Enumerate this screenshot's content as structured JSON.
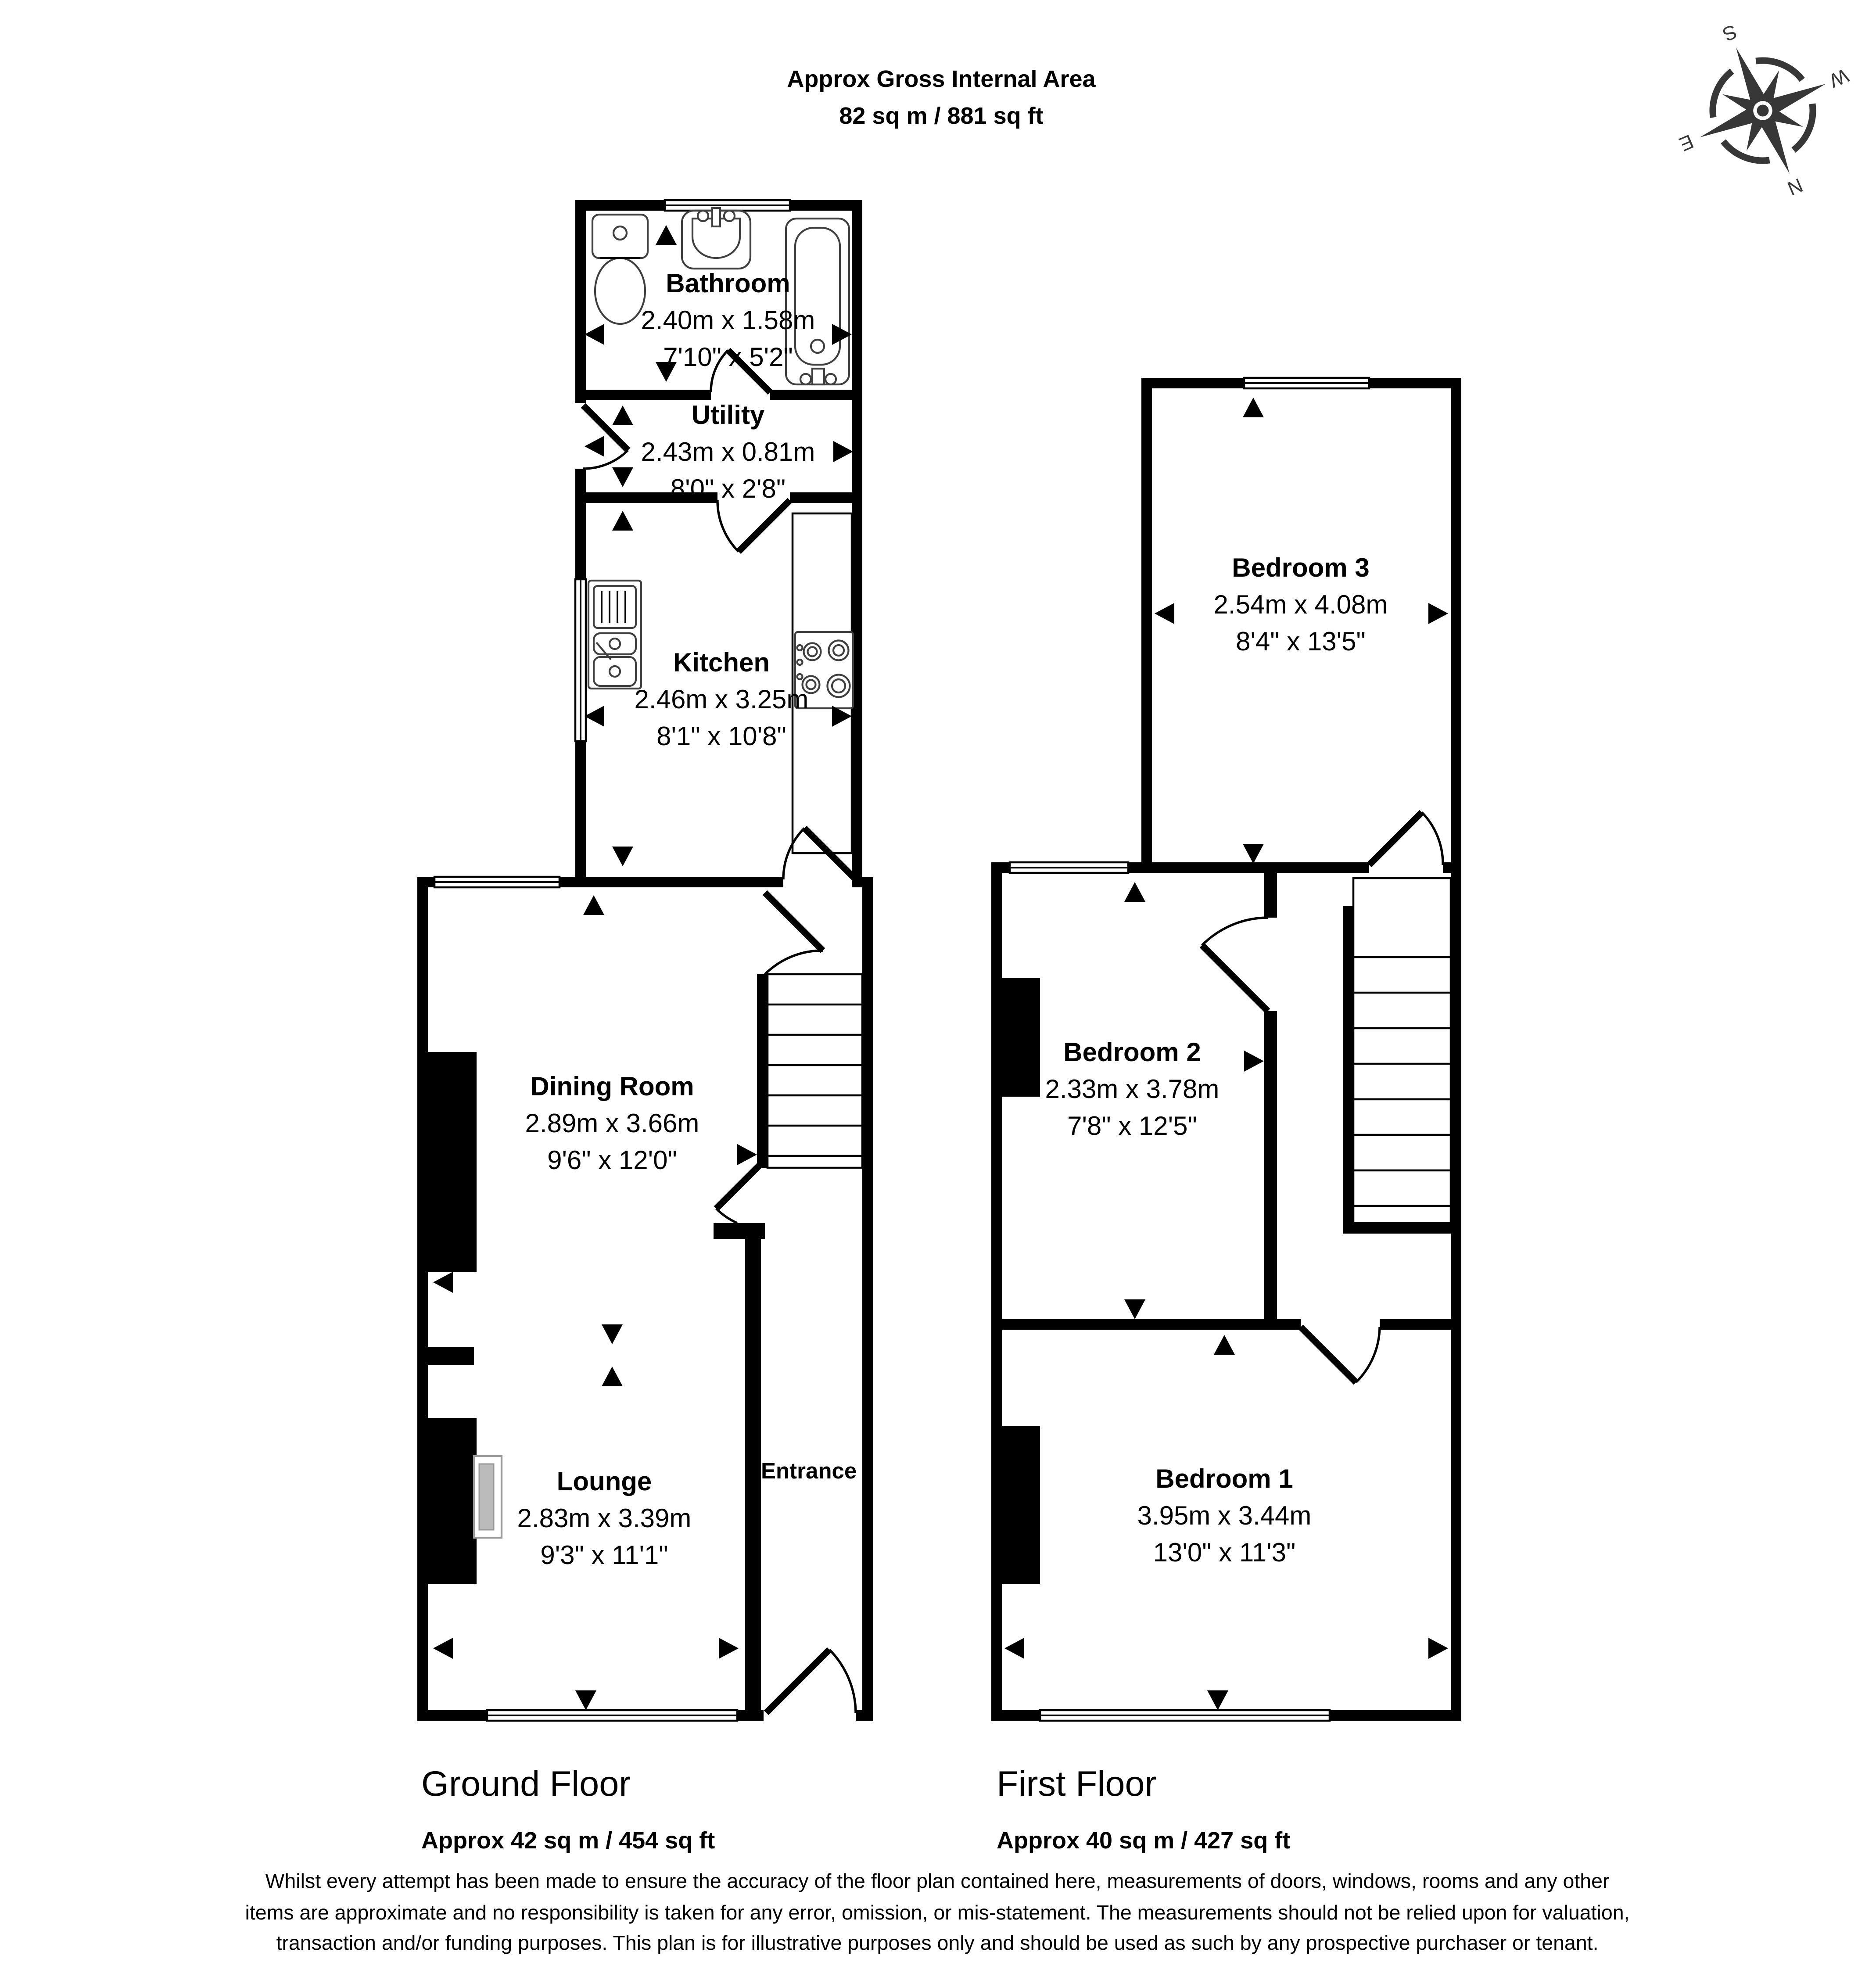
{
  "header": {
    "line1": "Approx Gross Internal Area",
    "line2": "82 sq m / 881 sq ft"
  },
  "compass": {
    "north": "N",
    "south": "S",
    "east": "E",
    "west": "W"
  },
  "ground_floor": {
    "label": "Ground Floor",
    "area": "Approx 42 sq m / 454 sq ft",
    "entrance": "Entrance",
    "rooms": {
      "bathroom": {
        "name": "Bathroom",
        "metric": "2.40m x 1.58m",
        "imperial": "7'10\" x 5'2\""
      },
      "utility": {
        "name": "Utility",
        "metric": "2.43m x 0.81m",
        "imperial": "8'0\" x 2'8\""
      },
      "kitchen": {
        "name": "Kitchen",
        "metric": "2.46m x 3.25m",
        "imperial": "8'1\" x 10'8\""
      },
      "dining": {
        "name": "Dining Room",
        "metric": "2.89m x 3.66m",
        "imperial": "9'6\" x 12'0\""
      },
      "lounge": {
        "name": "Lounge",
        "metric": "2.83m x 3.39m",
        "imperial": "9'3\" x 11'1\""
      }
    }
  },
  "first_floor": {
    "label": "First Floor",
    "area": "Approx 40 sq m / 427 sq ft",
    "rooms": {
      "bedroom3": {
        "name": "Bedroom 3",
        "metric": "2.54m x 4.08m",
        "imperial": "8'4\" x 13'5\""
      },
      "bedroom2": {
        "name": "Bedroom 2",
        "metric": "2.33m x 3.78m",
        "imperial": "7'8\" x 12'5\""
      },
      "bedroom1": {
        "name": "Bedroom 1",
        "metric": "3.95m x 3.44m",
        "imperial": "13'0\" x 11'3\""
      }
    }
  },
  "disclaimer": "Whilst every attempt has been made to ensure the accuracy of the floor plan contained here, measurements of doors, windows, rooms and any other items are approximate and no responsibility is taken for any error, omission, or mis-statement. The measurements should not be relied upon for valuation, transaction and/or funding purposes. This plan is for illustrative purposes only and should be used as such by any prospective purchaser or tenant.",
  "colors": {
    "wall": "#000000",
    "compass": "#373737",
    "fixture": "#3f3f3f"
  }
}
